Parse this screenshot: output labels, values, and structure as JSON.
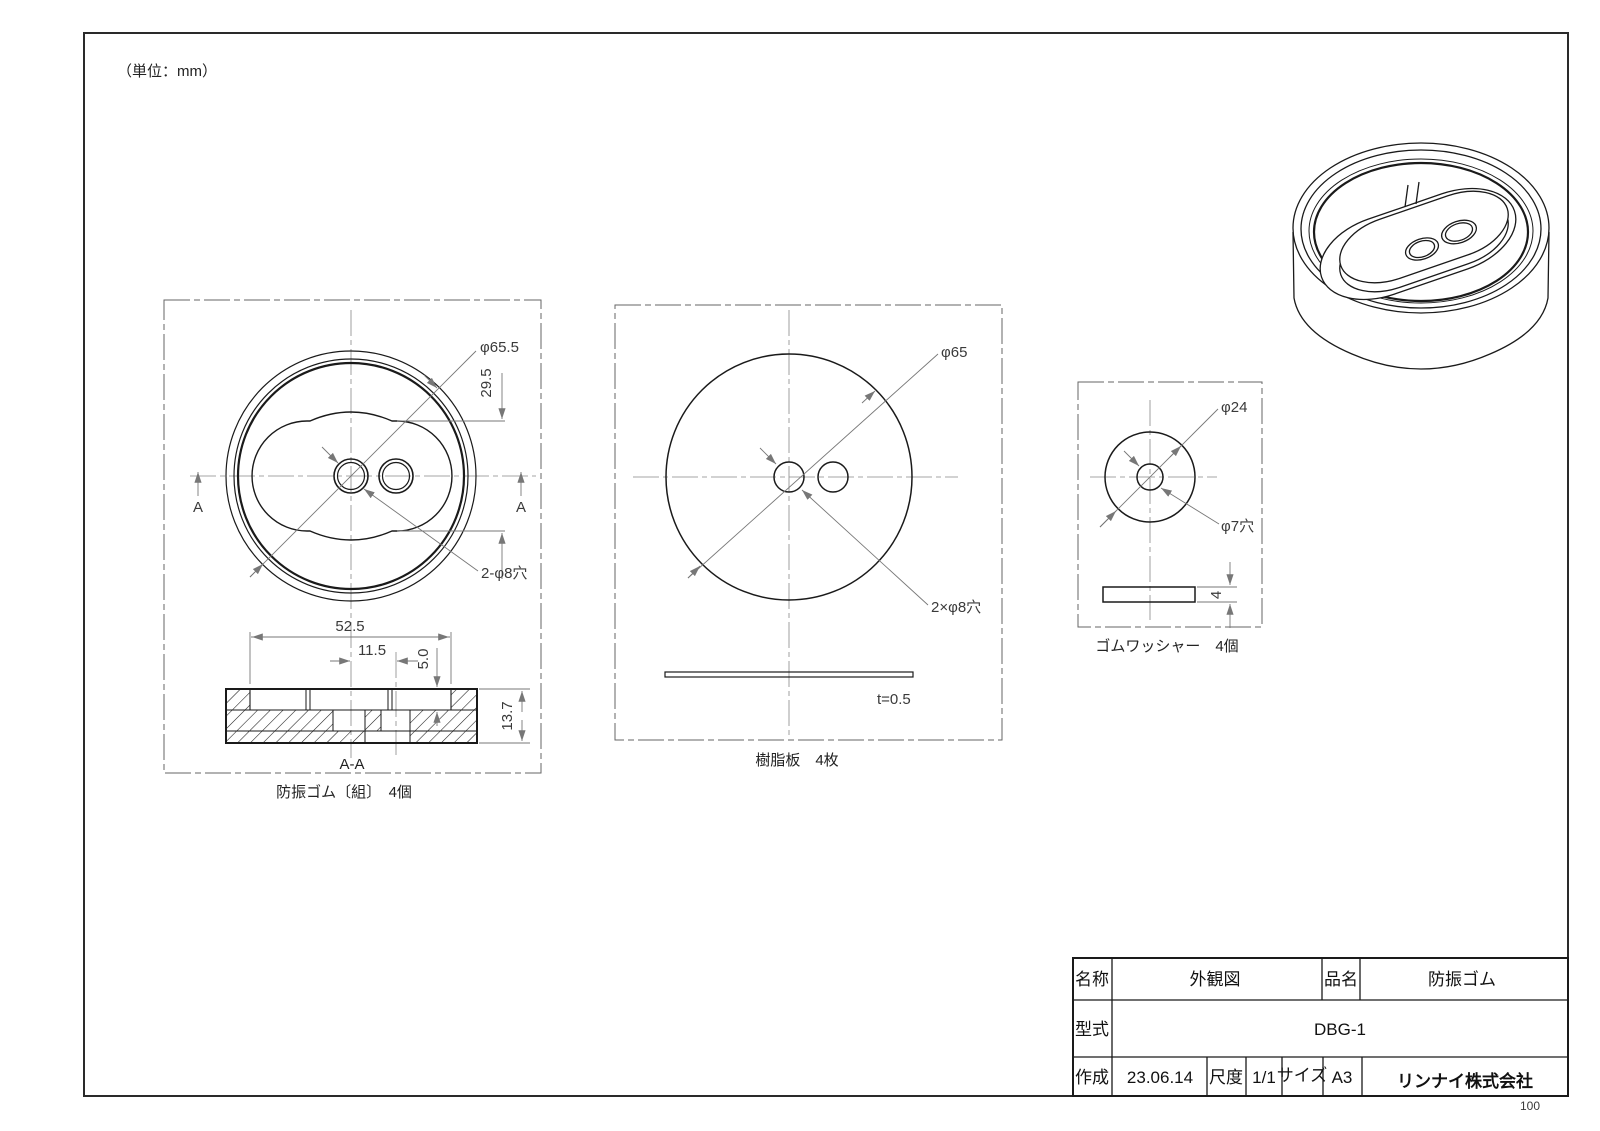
{
  "unit_note": "（単位：mm）",
  "page_number": "100",
  "colors": {
    "line": "#1a1a1a",
    "dim": "#777777",
    "background": "#ffffff"
  },
  "views": {
    "assembly_front": {
      "dim_outer_dia": "φ65.5",
      "dim_boss_height": "29.5",
      "dim_holes": "2-φ8穴",
      "section_arrow_left": "A",
      "section_arrow_right": "A"
    },
    "assembly_section": {
      "label": "A-A",
      "dim_recess_width": "52.5",
      "dim_hole_pitch": "11.5",
      "dim_recess_depth": "5.0",
      "dim_total_height": "13.7",
      "caption": "防振ゴム〔組〕　4個"
    },
    "resin_plate": {
      "dim_outer_dia": "φ65",
      "dim_holes": "2×φ8穴",
      "dim_thickness": "t=0.5",
      "caption": "樹脂板　4枚"
    },
    "rubber_washer": {
      "dim_outer_dia": "φ24",
      "dim_hole": "φ7穴",
      "dim_thickness": "4",
      "caption": "ゴムワッシャー　4個"
    }
  },
  "title_block": {
    "name_label": "名称",
    "name_value": "外観図",
    "product_label": "品名",
    "product_value": "防振ゴム",
    "model_label": "型式",
    "model_value": "DBG-1",
    "created_label": "作成",
    "created_value": "23.06.14",
    "scale_label": "尺度",
    "scale_value": "1/1",
    "size_label": "サイズ",
    "size_value": "A3",
    "company": "リンナイ株式会社"
  }
}
